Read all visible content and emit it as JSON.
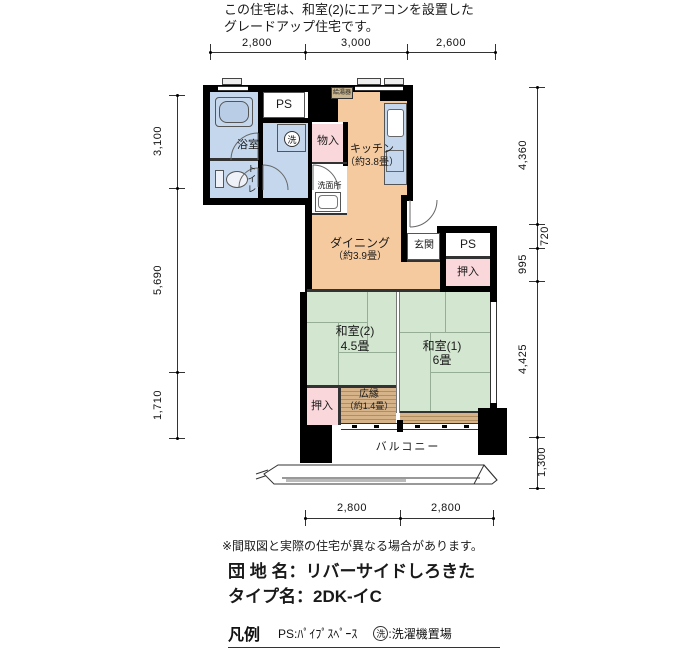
{
  "header": {
    "note1": "この住宅は、和室(2)にエアコンを設置した",
    "note2": "グレードアップ住宅です。"
  },
  "dims": {
    "top": [
      "2,800",
      "3,000",
      "2,600"
    ],
    "left": [
      "3,100",
      "5,690",
      "1,710"
    ],
    "right": [
      "4,360",
      "720",
      "995",
      "4,425",
      "1,300"
    ],
    "bottom": [
      "2,800",
      "2,800"
    ]
  },
  "rooms": {
    "bath": "浴室",
    "toilet": "トイレ",
    "ps_top": "PS",
    "washer_mark": "洗",
    "monoire": "物入",
    "washroom": "洗面所",
    "water_heater": "給湯器",
    "kitchen1": "キッチン",
    "kitchen2": "（約3.8畳）",
    "dining1": "ダイニング",
    "dining2": "（約3.9畳）",
    "genkan": "玄関",
    "ps_right": "PS",
    "oshiire_upper": "押入",
    "washitsu2_1": "和室(2)",
    "washitsu2_2": "4.5畳",
    "washitsu1_1": "和室(1)",
    "washitsu1_2": "6畳",
    "oshiire_lower": "押入",
    "hiroen1": "広縁",
    "hiroen2": "（約1.4畳）",
    "balcony": "バルコニー"
  },
  "footer": {
    "disclaimer": "※間取図と実際の住宅が異なる場合があります。",
    "estate": "団 地 名：リバーサイドしろきた",
    "type": "タイプ名：2DK-イC",
    "legend_title": "凡例",
    "legend_ps": "PS:ﾊﾟｲﾌﾟｽﾍﾟｰｽ",
    "wash_mark": "洗",
    "legend_wash": ":洗濯機置場"
  },
  "colors": {
    "wall": "#000000",
    "dk_orange": "#F5CA9F",
    "water_blue": "#C4D7EC",
    "closet_pink": "#F9D7DA",
    "tatami_green": "#D3E7D0",
    "wood": "#D2AF83"
  }
}
